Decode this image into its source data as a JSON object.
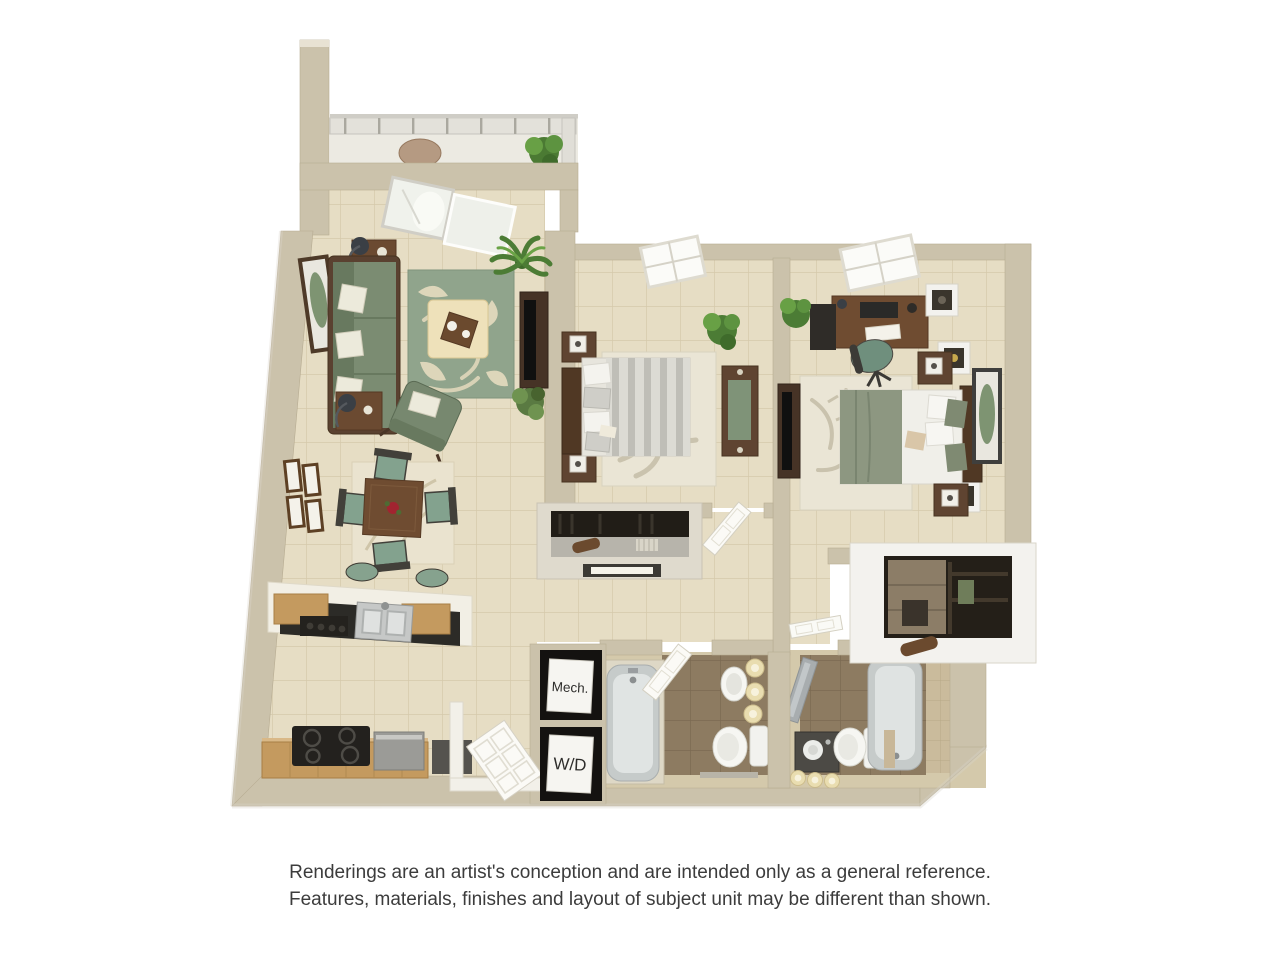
{
  "page": {
    "type": "3D apartment floor plan rendering",
    "background": "#ffffff"
  },
  "floor_plan": {
    "unit_summary": {
      "bedrooms": 2,
      "bathrooms": 2,
      "balcony": true
    },
    "labels": {
      "mechanical_closet": "Mech.",
      "washer_dryer": "W/D"
    },
    "rooms": [
      "balcony",
      "living room",
      "dining area",
      "kitchen",
      "bedroom 1",
      "bedroom 2",
      "bathroom 1",
      "bathroom 2",
      "hallway",
      "reach-in closet",
      "walk-in closet",
      "mechanical closet",
      "washer-dryer closet",
      "entry"
    ],
    "furniture": {
      "living_room": [
        "sofa",
        "two end tables with lamps",
        "area rug",
        "ottoman coffee table",
        "armchair",
        "media console with tv",
        "wall art",
        "plants"
      ],
      "dining_area": [
        "square dining table",
        "four chairs",
        "rug",
        "four wall frames",
        "breakfast bar with two stools"
      ],
      "kitchen": [
        "double sink",
        "cooktop range",
        "dishwasher",
        "oak cabinets",
        "black countertop"
      ],
      "bedroom_1": [
        "bed with striped duvet",
        "two nightstands",
        "dresser",
        "rug",
        "plant",
        "window"
      ],
      "bedroom_2": [
        "bed with sage duvet",
        "desk with computer",
        "office chair",
        "cube shelves",
        "two nightstands",
        "tv stand",
        "rug",
        "wall art",
        "window"
      ],
      "bathroom_1": [
        "bathtub",
        "pedestal sink",
        "toilet",
        "candles"
      ],
      "bathroom_2": [
        "bathtub",
        "vanity sink",
        "toilet",
        "glass panel",
        "candles"
      ],
      "balcony": [
        "railing",
        "round table",
        "potted plant"
      ]
    }
  },
  "disclaimer": {
    "line1": "Renderings are an artist's conception and are intended only as a general reference.",
    "line2": "Features, materials, finishes and layout of subject unit may be different than shown."
  },
  "palette": {
    "wall_tan": "#cbc2ab",
    "wall_light": "#e8e2d3",
    "floor_cream_tile": "#e6ddc4",
    "bath_tile_brown": "#8d7b61",
    "bath_wall_tan": "#cabb9c",
    "sofa_green": "#77886f",
    "dining_chair_green": "#83a28e",
    "wood_brown": "#6f4c31",
    "dark_wood": "#503824",
    "rug_green": "#90a48c",
    "cabinet_oak": "#c49a5f",
    "counter_black": "#2c2b27",
    "fixture_white": "#f4f4f0",
    "tub_gray": "#c6cbca",
    "plant_green": "#4c7c35",
    "bedding_sage": "#8d9781",
    "balcony_floor": "#eceae2"
  }
}
